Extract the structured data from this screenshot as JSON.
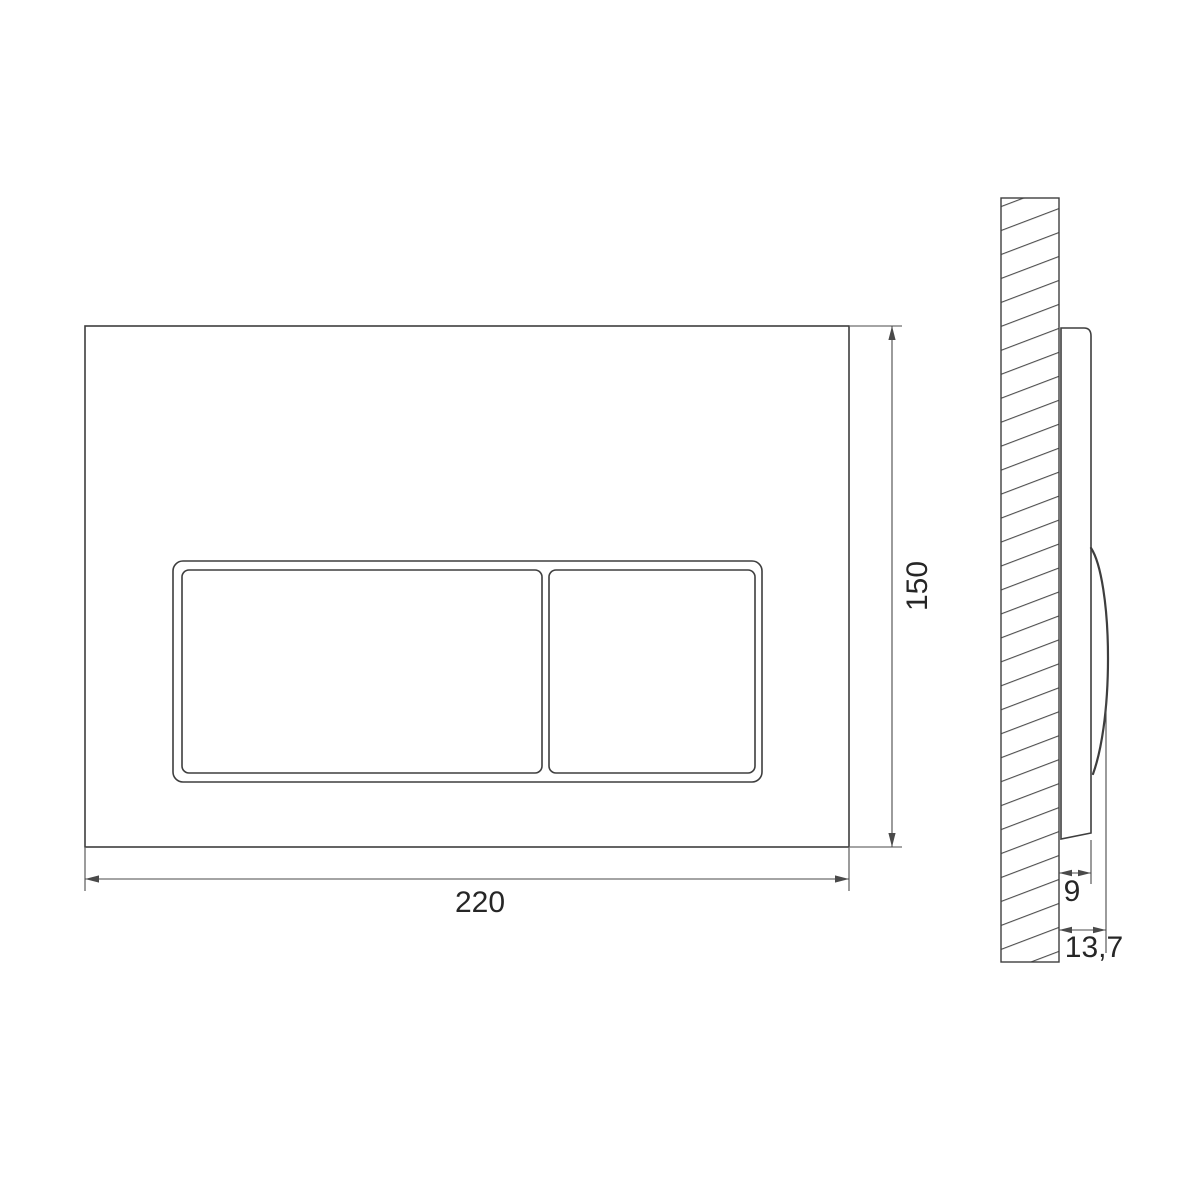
{
  "drawing": {
    "background": "#ffffff",
    "colors": {
      "line": "#3e3e3e",
      "dimension": "#4a4a4a",
      "hatch": "#4f4f4f",
      "text": "#262626"
    },
    "front_view": {
      "dimensions": {
        "width": "220",
        "height": "150"
      }
    },
    "side_view": {
      "dimensions": {
        "plate_depth": "9",
        "total_depth": "13,7"
      }
    }
  }
}
